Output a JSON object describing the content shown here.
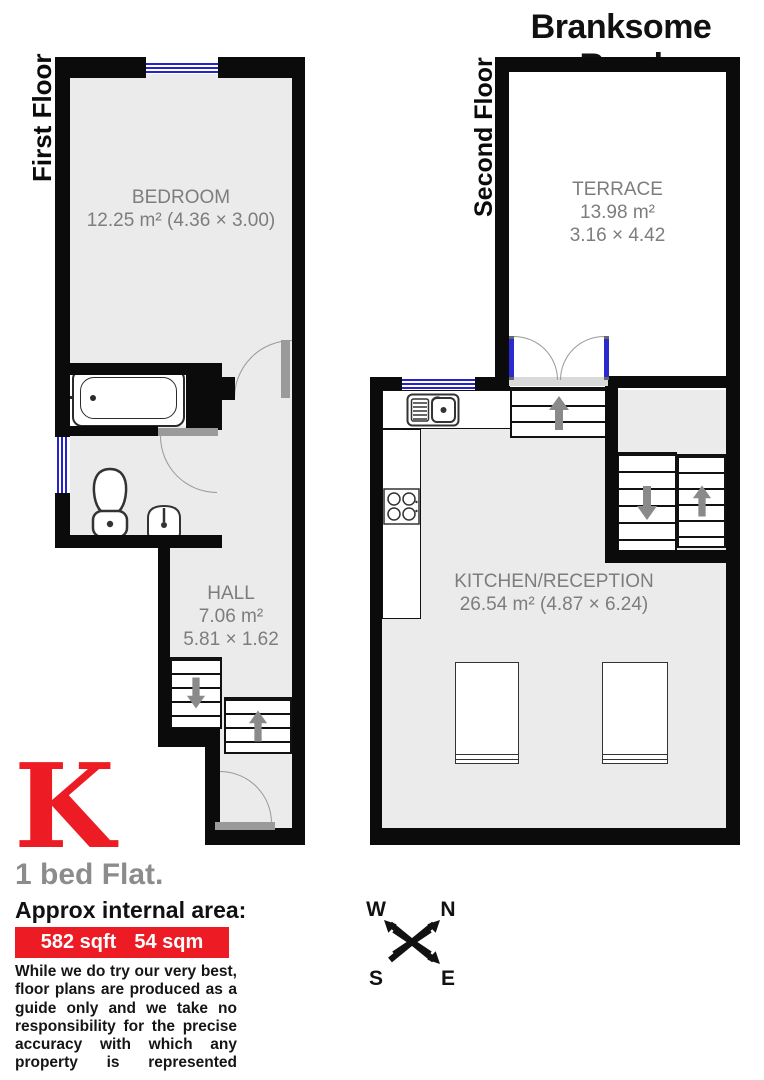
{
  "title": "Branksome Road",
  "floors": {
    "first": {
      "label": "First Floor"
    },
    "second": {
      "label": "Second Floor"
    }
  },
  "rooms": {
    "bedroom": {
      "name": "BEDROOM",
      "area_line": "12.25 m² (4.36 × 3.00)"
    },
    "hall": {
      "name": "HALL",
      "area_line": "7.06 m²",
      "dims_line": "5.81 × 1.62"
    },
    "terrace": {
      "name": "TERRACE",
      "area_line": "13.98 m²",
      "dims_line": "3.16 × 4.42"
    },
    "kitchen_reception": {
      "name": "KITCHEN/RECEPTION",
      "area_line": "26.54 m² (4.87 × 6.24)"
    }
  },
  "compass": {
    "west": "W",
    "north": "N",
    "south": "S",
    "east": "E"
  },
  "branding": {
    "logo_letter": "K",
    "property_type": "1 bed Flat.",
    "area_heading": "Approx internal area:",
    "area_imperial": "582 sqft",
    "area_metric": "54 sqm",
    "disclaimer": "While we do try our very best, floor plans are produced as a guide only and we take no responsibility for the precise accuracy with which any property is represented"
  },
  "colors": {
    "wall": "#0b0b0b",
    "room_fill": "#ebebeb",
    "window_blue": "#2424c8",
    "accent_red": "#ed1c24",
    "label_gray": "#7d7d7d",
    "arrow_gray": "#8a8a8a"
  }
}
